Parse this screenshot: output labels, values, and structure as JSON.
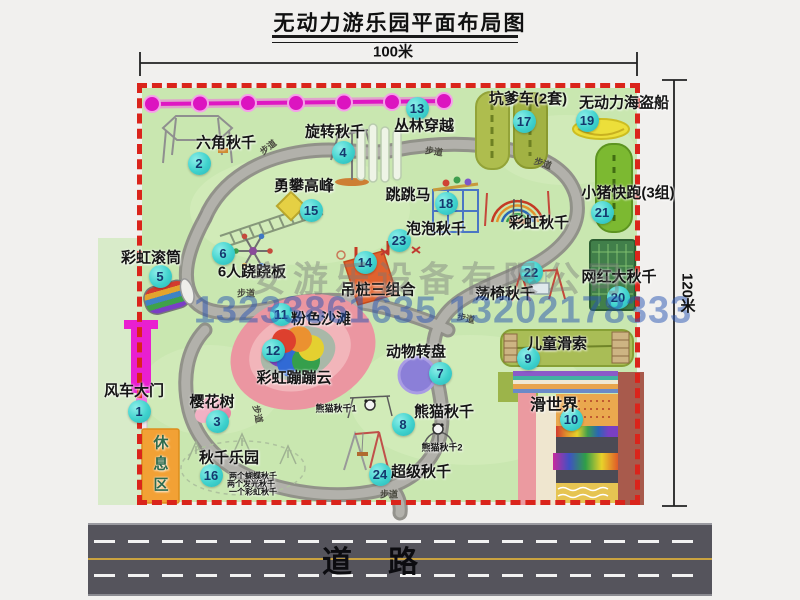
{
  "title": "无动力游乐园平面布局图",
  "dimensions": {
    "width_label": "100米",
    "height_label": "120米"
  },
  "road": {
    "label": "道路"
  },
  "watermark": {
    "company": "安游乐设备有限公司",
    "phone": "13233861635 13202178333"
  },
  "map": {
    "border_color": "#da241b",
    "ground_color": "#c9e7b0",
    "badge_color": "#3fd2cd",
    "items": [
      {
        "num": 1,
        "label": "风车大门",
        "badge": [
          139,
          411
        ],
        "label_pos": [
          134,
          390
        ]
      },
      {
        "num": 2,
        "label": "六角秋千",
        "badge": [
          199,
          163
        ],
        "label_pos": [
          226,
          142
        ]
      },
      {
        "num": 3,
        "label": "樱花树",
        "badge": [
          217,
          421
        ],
        "label_pos": [
          212,
          401
        ]
      },
      {
        "num": 4,
        "label": "旋转秋千",
        "badge": [
          343,
          152
        ],
        "label_pos": [
          335,
          131
        ]
      },
      {
        "num": 5,
        "label": "彩虹滚筒",
        "badge": [
          160,
          276
        ],
        "label_pos": [
          151,
          257
        ]
      },
      {
        "num": 6,
        "label": "6人跷跷板",
        "badge": [
          223,
          253
        ],
        "label_pos": [
          252,
          271
        ]
      },
      {
        "num": 7,
        "label": "动物转盘",
        "badge": [
          440,
          373
        ],
        "label_pos": [
          416,
          351
        ]
      },
      {
        "num": 8,
        "label": "熊猫秋千",
        "badge": [
          403,
          424
        ],
        "label_pos": [
          444,
          411
        ]
      },
      {
        "num": 9,
        "label": "儿童滑索",
        "badge": [
          528,
          358
        ],
        "label_pos": [
          557,
          343
        ]
      },
      {
        "num": 10,
        "label": "滑世界",
        "badge": [
          571,
          419
        ],
        "label_pos": [
          554,
          403
        ],
        "size": 16
      },
      {
        "num": 11,
        "label": "粉色沙滩",
        "badge": [
          281,
          314
        ],
        "label_pos": [
          321,
          318
        ]
      },
      {
        "num": 12,
        "label": "彩虹蹦蹦云",
        "badge": [
          273,
          350
        ],
        "label_pos": [
          294,
          377
        ]
      },
      {
        "num": 13,
        "label": "丛林穿越",
        "badge": [
          417,
          108
        ],
        "label_pos": [
          424,
          125
        ]
      },
      {
        "num": 14,
        "label": "吊桩三组合",
        "badge": [
          365,
          262
        ],
        "label_pos": [
          378,
          289
        ]
      },
      {
        "num": 15,
        "label": "勇攀高峰",
        "badge": [
          311,
          210
        ],
        "label_pos": [
          304,
          185
        ]
      },
      {
        "num": 16,
        "label": "秋千乐园",
        "badge": [
          211,
          475
        ],
        "label_pos": [
          229,
          457
        ]
      },
      {
        "num": 17,
        "label": "坑爹车(2套)",
        "badge": [
          524,
          121
        ],
        "label_pos": [
          528,
          98
        ]
      },
      {
        "num": 18,
        "label": "跳跳马",
        "badge": [
          446,
          203
        ],
        "label_pos": [
          408,
          194
        ]
      },
      {
        "num": 19,
        "label": "无动力海盗船",
        "badge": [
          587,
          120
        ],
        "label_pos": [
          624,
          102
        ]
      },
      {
        "num": 20,
        "label": "网红大秋千",
        "badge": [
          618,
          297
        ],
        "label_pos": [
          619,
          276
        ]
      },
      {
        "num": 21,
        "label": "小猪快跑(3组)",
        "badge": [
          602,
          212
        ],
        "label_pos": [
          628,
          192
        ]
      },
      {
        "num": 22,
        "label": "荡椅秋千",
        "badge": [
          531,
          272
        ],
        "label_pos": [
          505,
          293
        ]
      },
      {
        "num": 23,
        "label": "泡泡秋千",
        "badge": [
          399,
          240
        ],
        "label_pos": [
          436,
          228
        ]
      },
      {
        "num": 24,
        "label": "超级秋千",
        "badge": [
          380,
          474
        ],
        "label_pos": [
          421,
          471
        ]
      }
    ],
    "extra_labels": [
      {
        "text": "彩虹秋千",
        "pos": [
          539,
          222
        ],
        "size": 15
      },
      {
        "text": "休息区",
        "pos": [
          160,
          466
        ],
        "size": 15,
        "vertical": true,
        "color": "#2e6b4e"
      },
      {
        "text": "熊猫秋千1",
        "pos": [
          336,
          408
        ],
        "size": 9
      },
      {
        "text": "熊猫秋千2",
        "pos": [
          442,
          447
        ],
        "size": 9
      },
      {
        "text": "两个蝴蝶秋千",
        "pos": [
          253,
          476
        ],
        "size": 8
      },
      {
        "text": "两个发光秋千",
        "pos": [
          251,
          484
        ],
        "size": 8
      },
      {
        "text": "一个彩虹秋千",
        "pos": [
          253,
          492
        ],
        "size": 8
      }
    ],
    "path_labels": [
      {
        "text": "步道",
        "pos": [
          268,
          147
        ],
        "rot": -38
      },
      {
        "text": "步道",
        "pos": [
          434,
          151
        ],
        "rot": 8
      },
      {
        "text": "步道",
        "pos": [
          543,
          163
        ],
        "rot": 18
      },
      {
        "text": "步道",
        "pos": [
          246,
          293
        ],
        "rot": 0
      },
      {
        "text": "步道",
        "pos": [
          466,
          318
        ],
        "rot": 12
      },
      {
        "text": "步道",
        "pos": [
          258,
          414
        ],
        "rot": 78
      },
      {
        "text": "步道",
        "pos": [
          389,
          494
        ],
        "rot": 0
      }
    ]
  }
}
